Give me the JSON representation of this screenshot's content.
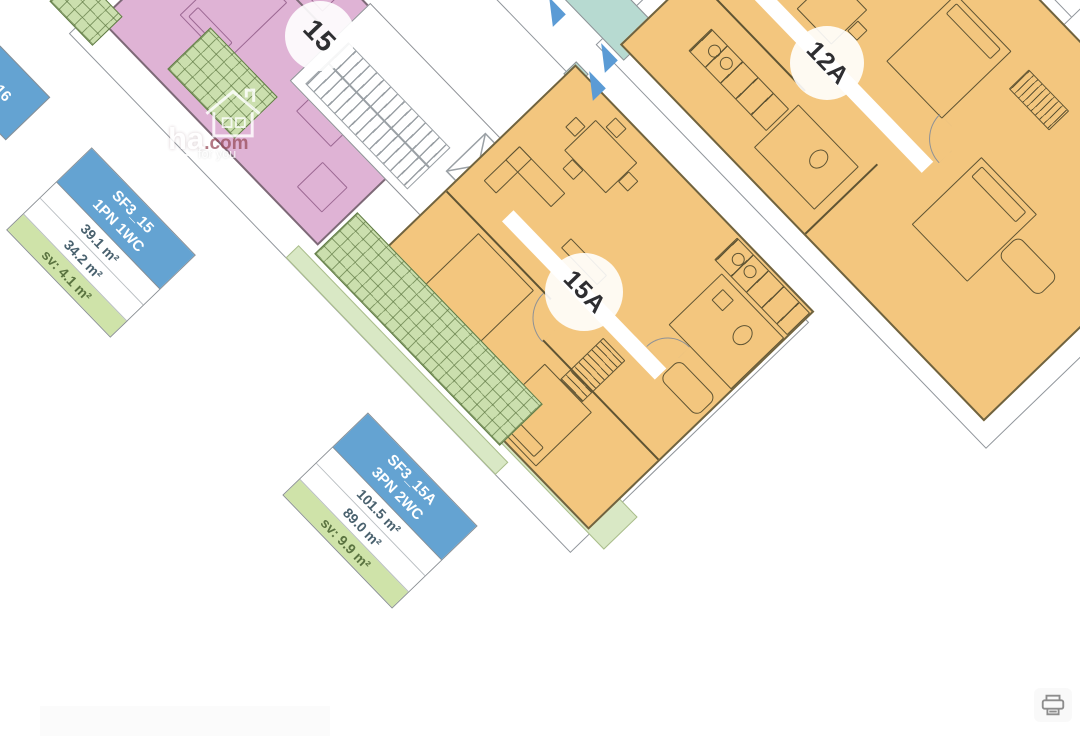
{
  "plan": {
    "unit_labels": {
      "u15": "15",
      "u15a": "15A",
      "u12a": "12A",
      "u16": "16"
    },
    "info_boxes": [
      {
        "code": "SF3_15",
        "layout": "1PN 1WC",
        "rows": [
          "39.1 m²",
          "34.2 m²",
          "sv: 4.1 m²"
        ]
      },
      {
        "code": "SF3_15A",
        "layout": "3PN 2WC",
        "rows": [
          "101.5 m²",
          "89.0 m²",
          "sv: 9.9 m²"
        ]
      }
    ],
    "colors": {
      "unit_fill_orange": "#f3c67e",
      "unit_fill_pink": "#dfb3d5",
      "balcony_hatch_green": "#cbdfae",
      "balcony_light_green": "#d9e8c5",
      "info_box_blue": "#64a3d2",
      "info_box_green_row": "#cfe3a9",
      "corridor_arrow_blue": "#5b9bd5",
      "teal_room": "#b7dad1",
      "outline_gray": "#8a8f94",
      "furniture_line_olive": "#5f5433"
    },
    "icons": {
      "corridor_arrows": "triangle-arrow-icon",
      "elevator": "elevator-shaft-x",
      "stairs": "staircase-treads"
    }
  },
  "watermark": {
    "brand": "ha",
    "suffix": ".com",
    "tagline": "for you",
    "icon": "house-icon"
  },
  "controls": {
    "print_icon": "printer-icon"
  }
}
